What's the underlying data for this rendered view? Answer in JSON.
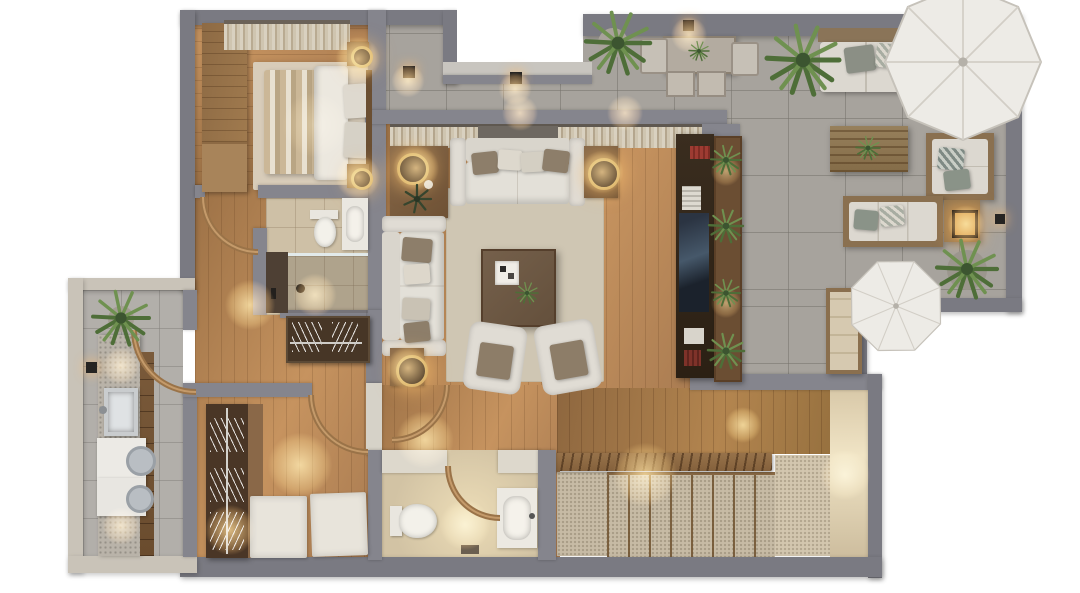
{
  "title": "3D rendered apartment floor plan, top-down view",
  "scene_type": "architectural-visualization",
  "background_color": "#ffffff",
  "rooms": [
    {
      "name": "Bedroom",
      "position": "top-left",
      "floor": "wood with beige rug",
      "items": [
        "wardrobe",
        "dresser",
        "double bed with striped duvet",
        "2 nightstands",
        "2 gold ring table lamps",
        "curtained window",
        "area rug"
      ]
    },
    {
      "name": "Bathroom",
      "position": "left-middle",
      "floor": "beige tile",
      "items": [
        "toilet",
        "vanity sink",
        "walk-in shower with glass",
        "dark counter with bottles"
      ]
    },
    {
      "name": "Hallway",
      "position": "left-center",
      "floor": "wood",
      "items": [
        "open coat rack with hangers",
        "door swing arcs",
        "wall lamp"
      ]
    },
    {
      "name": "Laundry room",
      "position": "bottom-left",
      "floor": "gray tile",
      "items": [
        "stone countertop",
        "steel sink",
        "washer",
        "dryer",
        "wood drawer cabinet",
        "potted plant",
        "wall lamp"
      ]
    },
    {
      "name": "Dressing room",
      "position": "bottom-center-left",
      "floor": "wood",
      "items": [
        "open wardrobe with hanger rods",
        "2 white storage ottomans"
      ]
    },
    {
      "name": "Guest bathroom",
      "position": "bottom-center",
      "floor": "beige tile",
      "items": [
        "toilet",
        "vanity sink",
        "bath mat",
        "door swing arc"
      ]
    },
    {
      "name": "Living room",
      "position": "center",
      "floor": "wood with light rug",
      "items": [
        "3-seat sofa with 4 pillows",
        "2-seat sofa with 4 pillows",
        "2 armchairs with brown cushions",
        "dark wood coffee table",
        "white tray",
        "console with ring lamp, candle and dark plant",
        "2 side tables with ring lamps",
        "full-width curtains with center window",
        "TV media wall with books and decor"
      ]
    },
    {
      "name": "Staircase hall",
      "position": "bottom-right",
      "floor": "wood landing + carpeted stairs",
      "items": [
        "slatted wood railing",
        "9 carpeted steps",
        "lower landing",
        "warm-lit wall"
      ]
    },
    {
      "name": "Terrace",
      "position": "top-right",
      "floor": "large gray tile",
      "items": [
        "dining table with plant",
        "2 chairs",
        "2 stools",
        "outdoor corner sofa with pillows",
        "outdoor 2-seat sofa",
        "slatted wood coffee table with plant",
        "lounge chair",
        "lantern side table",
        "large parasol",
        "small parasol",
        "potted ferns",
        "planter wall with 4 plants",
        "3 wall lamps"
      ]
    }
  ],
  "counts": {
    "parasols": 2,
    "door_arcs": 5,
    "plants": 10,
    "table_lamps": 5,
    "wall_lamps": 5
  },
  "palette": {
    "wall": "#85858d",
    "outer_wall": "#7a7a82",
    "cream_wall": "#c9c3b8",
    "wood_floor": "#b2855a",
    "terrace_tile": "#a7a39d",
    "bath_tile": "#cec0a6",
    "rug": "#cfc6b3",
    "sofa": "#e0dcd4",
    "wood_furniture": "#7c5f40",
    "dark_media_wall": "#32271b",
    "plant_green": "#5c7d46",
    "umbrella": "#edebe6",
    "lamp_glow": "#ffcc82",
    "carpet": "#c7bba5"
  }
}
